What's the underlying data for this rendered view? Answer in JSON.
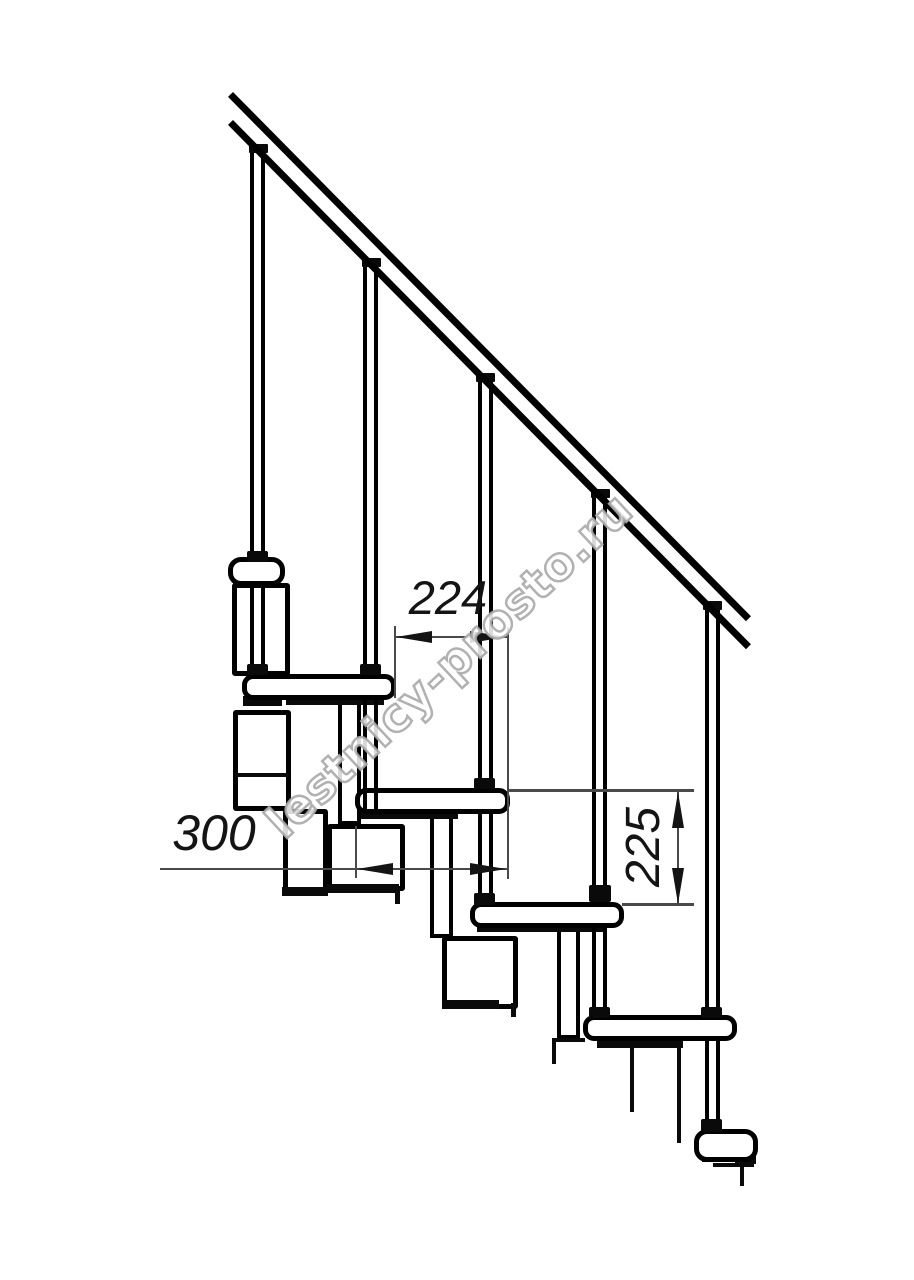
{
  "figure": {
    "type": "staircase-side-view-technical-drawing",
    "treads_visible": 6,
    "balusters_visible": 5,
    "has_handrail": true
  },
  "dimensions": {
    "step_run": "224",
    "tread_depth": "300",
    "step_rise": "225"
  },
  "watermark": {
    "text": "lestnicy-prosto.ru",
    "color": "#a8a8a8"
  },
  "colors": {
    "background": "#ffffff",
    "line": "#000000",
    "dimension_line": "#4a4a4a",
    "dimension_text": "#141414"
  }
}
